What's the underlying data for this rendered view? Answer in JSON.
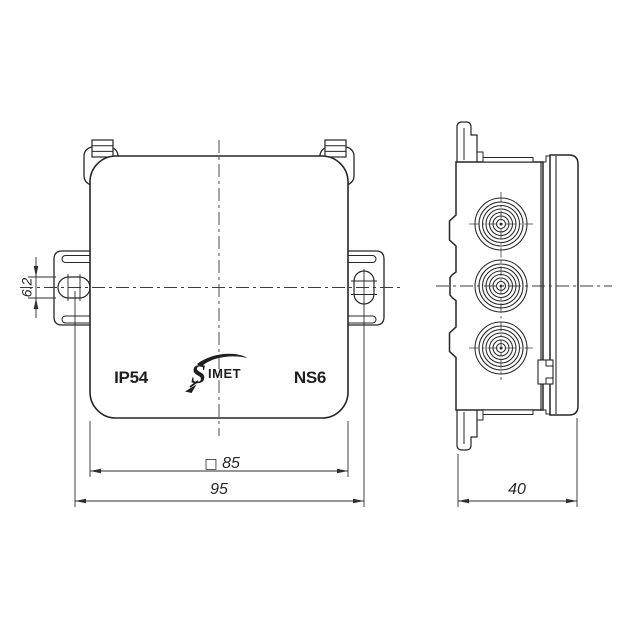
{
  "drawing": {
    "front_view": {
      "ip_rating": "IP54",
      "model": "NS6",
      "logo_initial": "S",
      "logo_text": "IMET"
    },
    "dimensions": {
      "slot_width": "6.2",
      "square_symbol": "□",
      "body_size": "85",
      "hole_spacing": "95",
      "depth": "40"
    },
    "colors": {
      "line": "#262626",
      "background": "#ffffff"
    }
  }
}
